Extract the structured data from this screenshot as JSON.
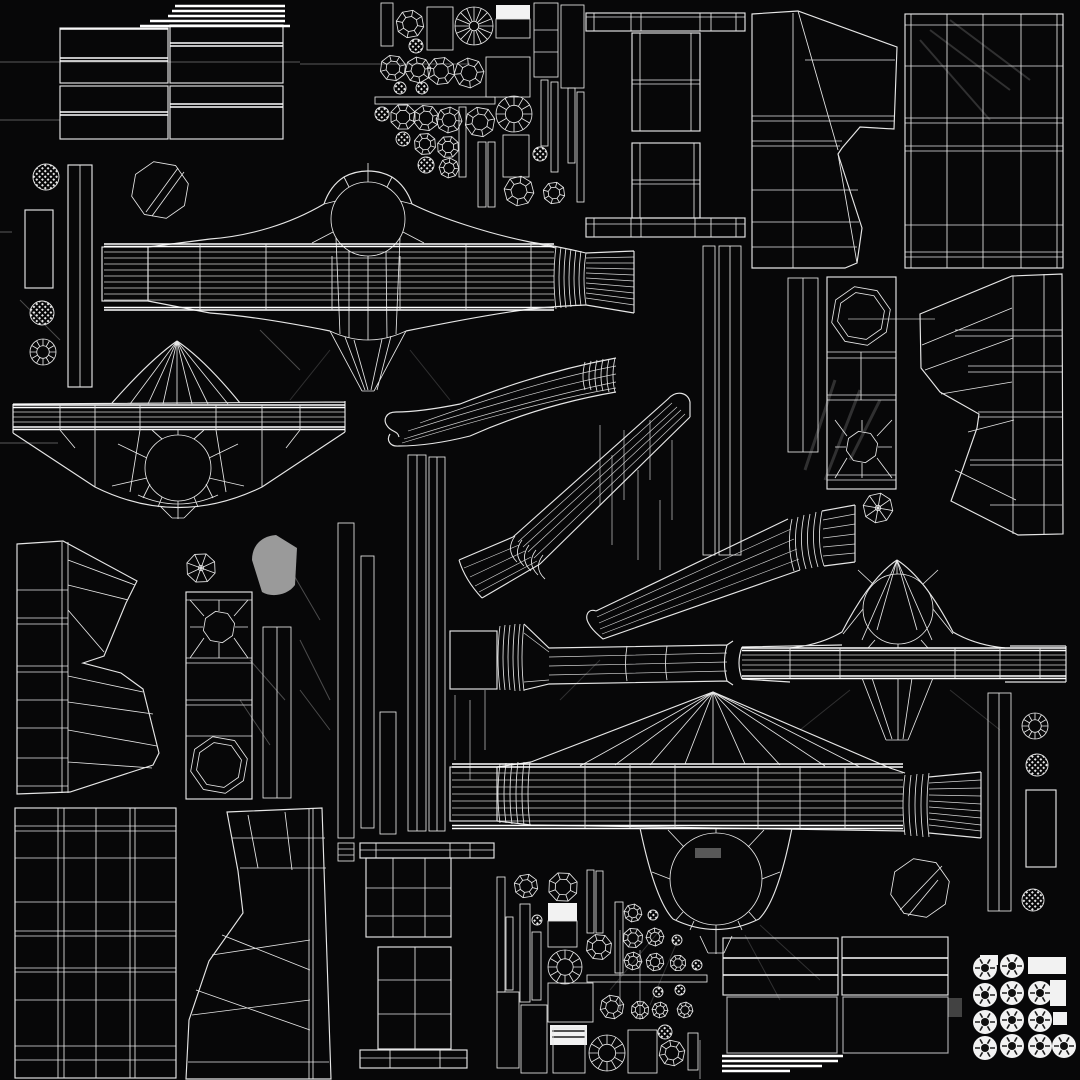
{
  "canvas": {
    "title": "Wireframe UV texture atlas - mechanical axle assembly",
    "width": 1080,
    "height": 1080
  },
  "palette": {
    "background": "#070708",
    "stroke": "#e6e6e6",
    "stroke_bright": "#ffffff",
    "stroke_faint": "#8f8f8f",
    "white_fill": "#f2f2f2",
    "gray_fill": "#9a9a9a"
  },
  "islands": [
    {
      "name": "tread-grid-top-left"
    },
    {
      "name": "bar-stack-top"
    },
    {
      "name": "left-column-parts"
    },
    {
      "name": "small-parts-cluster-top"
    },
    {
      "name": "ibeam-frame"
    },
    {
      "name": "ladder-strips-center-right"
    },
    {
      "name": "housing-central"
    },
    {
      "name": "housing-left"
    },
    {
      "name": "housing-right"
    },
    {
      "name": "housing-bottom"
    },
    {
      "name": "arm-upper"
    },
    {
      "name": "arm-diagonal"
    },
    {
      "name": "arm-lower"
    },
    {
      "name": "arm-right"
    },
    {
      "name": "boot-top-right"
    },
    {
      "name": "grid-panel-top-right"
    },
    {
      "name": "boot-right-mid"
    },
    {
      "name": "octagon-panel-right"
    },
    {
      "name": "ladder-small-right"
    },
    {
      "name": "boot-left-mid"
    },
    {
      "name": "gray-blob"
    },
    {
      "name": "octagon-column-left"
    },
    {
      "name": "ladder-strips-mid"
    },
    {
      "name": "pedestal-table"
    },
    {
      "name": "grid-panel-bottom-left"
    },
    {
      "name": "boot-bottom-left"
    },
    {
      "name": "small-parts-cluster-bottom"
    },
    {
      "name": "tread-grid-bottom-right"
    },
    {
      "name": "bar-stack-bottom"
    },
    {
      "name": "sprocket-cluster"
    },
    {
      "name": "misc-right-column"
    }
  ]
}
